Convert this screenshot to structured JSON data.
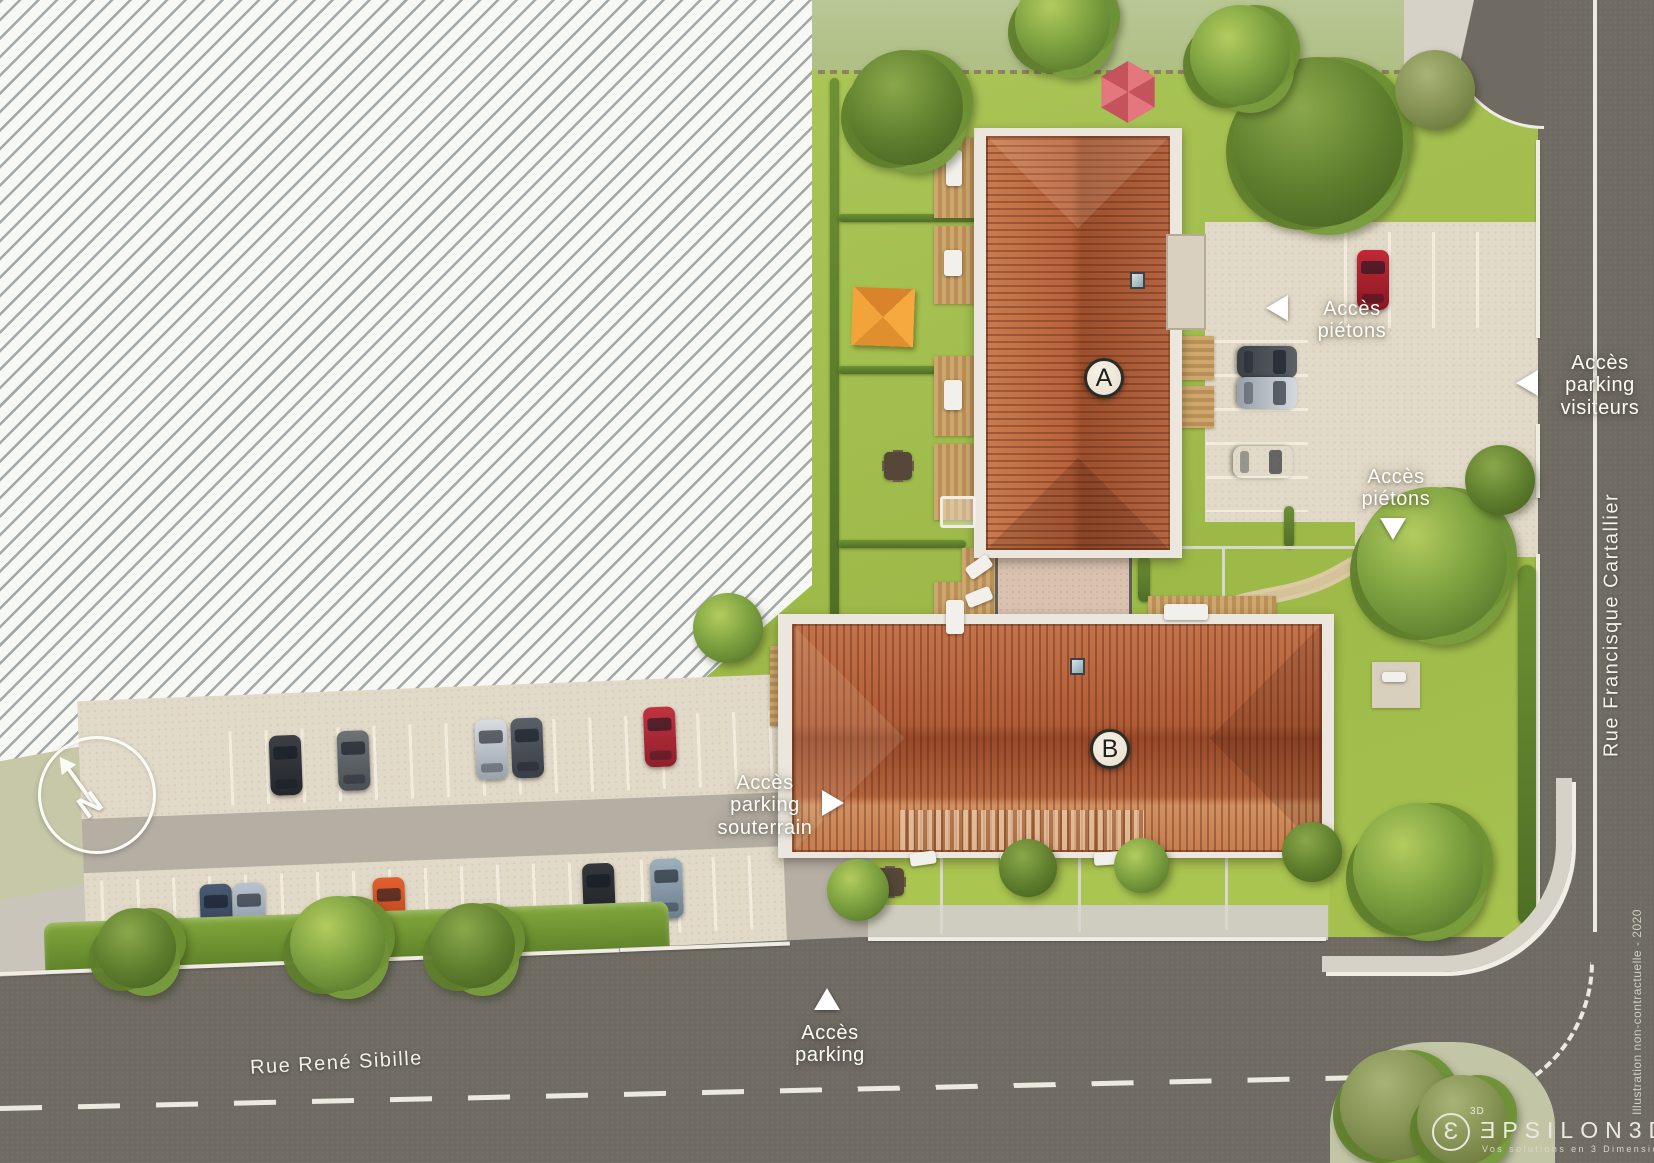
{
  "plan": {
    "building_a_label": "A",
    "building_b_label": "B",
    "compass_letter": "N"
  },
  "access_labels": {
    "pietons_north": "Accès\npiétons",
    "parking_visiteurs": "Accès\nparking\nvisiteurs",
    "pietons_east": "Accès\npiétons",
    "parking_souterrain": "Accès\nparking\nsouterrain",
    "parking_south": "Accès\nparking"
  },
  "streets": {
    "bottom": "Rue René Sibille",
    "right": "Rue Francisque Cartallier"
  },
  "footer": {
    "disclaimer": "Illustration non-contractuelle - 2020",
    "logo_glyph": "Ɛ",
    "logo_sup": "3D",
    "logo_text": "ƎPSILON3D",
    "logo_tagline": "Vos solutions en 3 Dimensions"
  },
  "colors": {
    "lawn": "#a4bf4f",
    "roof_tile": "#b4613c",
    "parking_beige": "#e2dac8",
    "driveway_gray": "#b5aea3",
    "road": "#6f6b63",
    "hatch_line": "#a2a7a8",
    "label_text": "#fdfdf8",
    "pale_green": "#c6c8a8"
  }
}
